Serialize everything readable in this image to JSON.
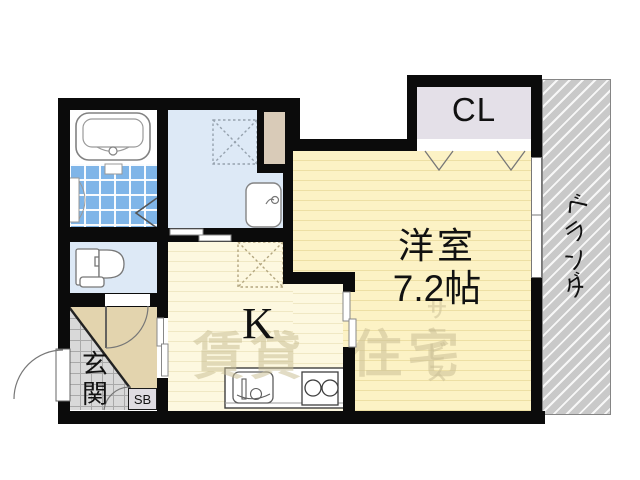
{
  "plan": {
    "type": "apartment-floor-plan",
    "rooms": {
      "closet": {
        "label": "CL"
      },
      "western_room": {
        "name_label": "洋室",
        "size_label": "7.2帖"
      },
      "kitchen": {
        "label": "K"
      },
      "entrance": {
        "label": "玄関"
      },
      "shoe_box": {
        "label": "SB"
      },
      "veranda": {
        "label": "ベランダ"
      }
    },
    "watermark": {
      "part1": "賃貸",
      "part2": "住宅",
      "vertical": "サービス"
    },
    "colors": {
      "wall": "#0b0b0b",
      "western_room_fill": "#fcf2c5",
      "kitchen_fill": "#fdf8e0",
      "wet_room_fill": "#dde9f6",
      "bath_tile_fill": "#7fb5e8",
      "entrance_hall_fill": "#e3d4ae",
      "entrance_tile_fill": "#d9d9d9",
      "closet_fill": "#e4e0e8",
      "veranda_fill": "#c9c9c9",
      "pipe_space_fill": "#d9cbb8",
      "watermark": "rgba(202,192,150,0.55)"
    }
  }
}
